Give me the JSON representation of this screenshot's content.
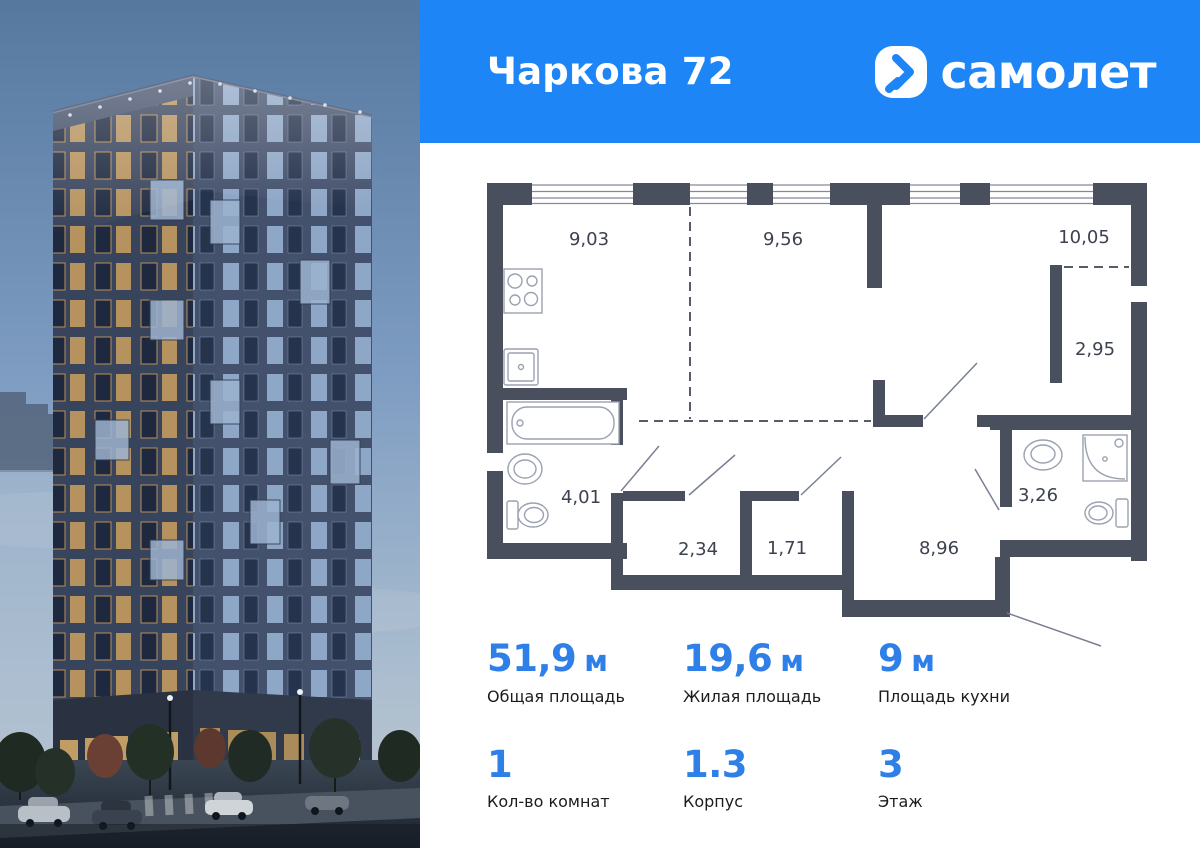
{
  "header": {
    "title": "Чаркова 72",
    "brand": "самолет"
  },
  "floor_plan": {
    "areas": {
      "kitchen_living": "9,03",
      "living_zone": "9,56",
      "bedroom": "10,05",
      "wardrobe": "2,95",
      "bathroom_main": "4,01",
      "storage_a": "2,34",
      "storage_b": "1,71",
      "hallway": "8,96",
      "bathroom_second": "3,26"
    }
  },
  "stats": {
    "primary": [
      {
        "value": "51,9",
        "unit": "м",
        "label": "Общая площадь"
      },
      {
        "value": "19,6",
        "unit": "м",
        "label": "Жилая площадь"
      },
      {
        "value": "9",
        "unit": "м",
        "label": "Площадь кухни"
      }
    ],
    "secondary": [
      {
        "value": "1",
        "label": "Кол-во комнат"
      },
      {
        "value": "1.3",
        "label": "Корпус"
      },
      {
        "value": "3",
        "label": "Этаж"
      }
    ]
  },
  "colors": {
    "brand_blue": "#1e85f6",
    "value_blue": "#2e7fe8",
    "wall": "#4a4f5d"
  }
}
